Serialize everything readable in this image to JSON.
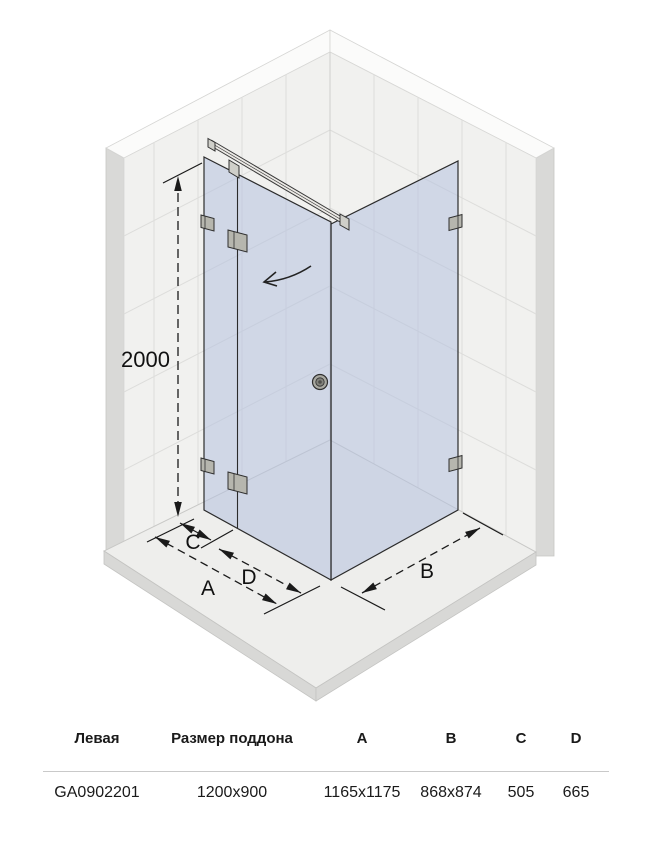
{
  "diagram": {
    "labels": {
      "height": "2000",
      "a": "A",
      "b": "B",
      "c": "C",
      "d": "D"
    },
    "icons": [
      "door-swing-arrow",
      "door-knob",
      "wall-bracket",
      "hinge-bracket",
      "support-bar"
    ],
    "colors": {
      "glass": "#b4c1de",
      "wall_tile": "#f1f1ef",
      "grout": "#dddddb",
      "wall_top_edge": "#fbfbfa",
      "wall_side": "#d9d9d7",
      "floor_top": "#eeeeec",
      "floor_side": "#d8d8d6",
      "dimension_line": "#1a1a1a",
      "hardware": "#cfcfc9"
    }
  },
  "table": {
    "headers": [
      "Левая",
      "Размер поддона",
      "A",
      "B",
      "C",
      "D"
    ],
    "row": [
      "GA0902201",
      "1200x900",
      "1165x1175",
      "868x874",
      "505",
      "665"
    ]
  }
}
